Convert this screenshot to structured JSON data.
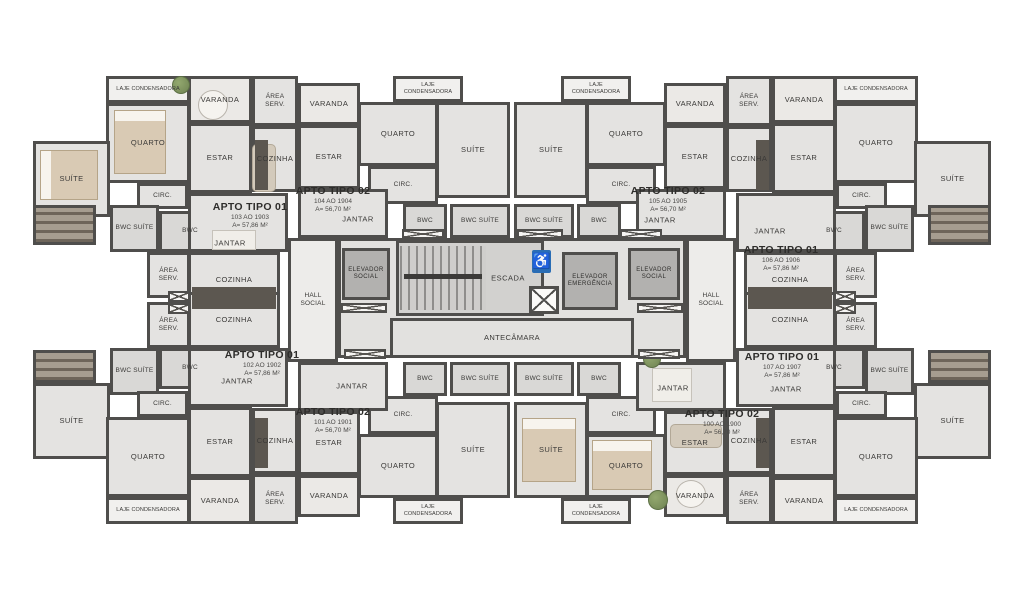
{
  "rooms": {
    "laje": "LAJE CONDENSADORA",
    "varanda": "VARANDA",
    "area_serv": "ÁREA SERV.",
    "quarto": "QUARTO",
    "estar": "ESTAR",
    "cozinha": "COZINHA",
    "suite": "SUÍTE",
    "circ": "CIRC.",
    "bwc": "BWC",
    "bwc_suite": "BWC SUÍTE",
    "jantar": "JANTAR",
    "hall_social": "HALL SOCIAL",
    "escada": "ESCADA",
    "elev_social": "ELEVADOR SOCIAL",
    "elev_emerg": "ELEVADOR EMERGÊNCIA",
    "antecamara": "ANTECÂMARA"
  },
  "apartments": {
    "a100": {
      "title": "APTO TIPO 02",
      "range": "100 AO 1900",
      "area": "A= 56,70 M²"
    },
    "a101": {
      "title": "APTO TIPO 02",
      "range": "101 AO 1901",
      "area": "A= 56,70 M²"
    },
    "a102": {
      "title": "APTO TIPO 01",
      "range": "102 AO 1902",
      "area": "A= 57,86 M²"
    },
    "a103": {
      "title": "APTO TIPO 01",
      "range": "103 AO 1903",
      "area": "A= 57,86 M²"
    },
    "a104": {
      "title": "APTO TIPO 02",
      "range": "104 AO 1904",
      "area": "A= 56,70 M²"
    },
    "a105": {
      "title": "APTO TIPO 02",
      "range": "105 AO 1905",
      "area": "A= 56,70 M²"
    },
    "a106": {
      "title": "APTO TIPO 01",
      "range": "106 AO 1906",
      "area": "A= 57,86 M²"
    },
    "a107": {
      "title": "APTO TIPO 01",
      "range": "107 AO 1907",
      "area": "A= 57,86 M²"
    }
  },
  "icons": {
    "wheelchair": "♿"
  },
  "colors": {
    "wall": "#4f4e4c",
    "floor": "#e4e3e1",
    "accessible_blue": "#2a6db5"
  }
}
